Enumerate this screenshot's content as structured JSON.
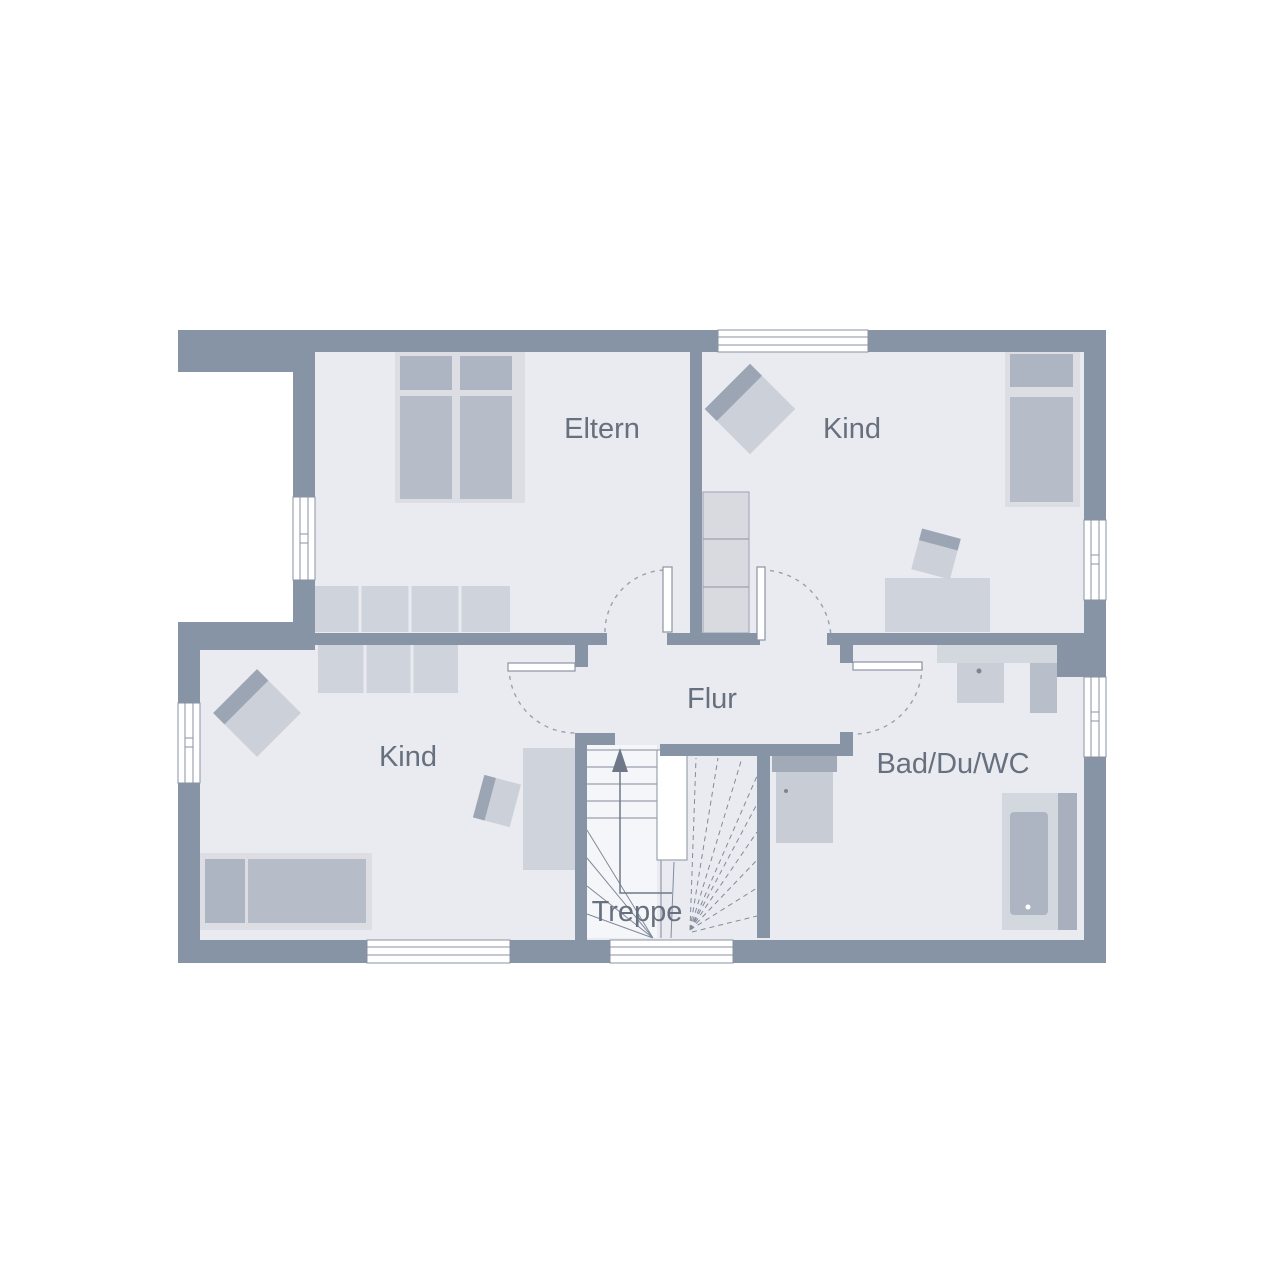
{
  "plan": {
    "rooms": [
      {
        "id": "eltern",
        "label": "Eltern"
      },
      {
        "id": "kind-top-right",
        "label": "Kind"
      },
      {
        "id": "kind-bottom-left",
        "label": "Kind"
      },
      {
        "id": "flur",
        "label": "Flur"
      },
      {
        "id": "bad-du-wc",
        "label": "Bad/Du/WC"
      },
      {
        "id": "treppe",
        "label": "Treppe"
      }
    ],
    "colors": {
      "background": "#FFFFFF",
      "wall": "#8794A6",
      "floor": "#E9EBF0",
      "furniture_light": "#CFD3DB",
      "furniture_medium": "#B6BCC8",
      "furniture_dark": "#9CA5B4",
      "outline": "#8A93A3",
      "label_text": "#67707E",
      "stair_line": "#818B9B"
    }
  }
}
